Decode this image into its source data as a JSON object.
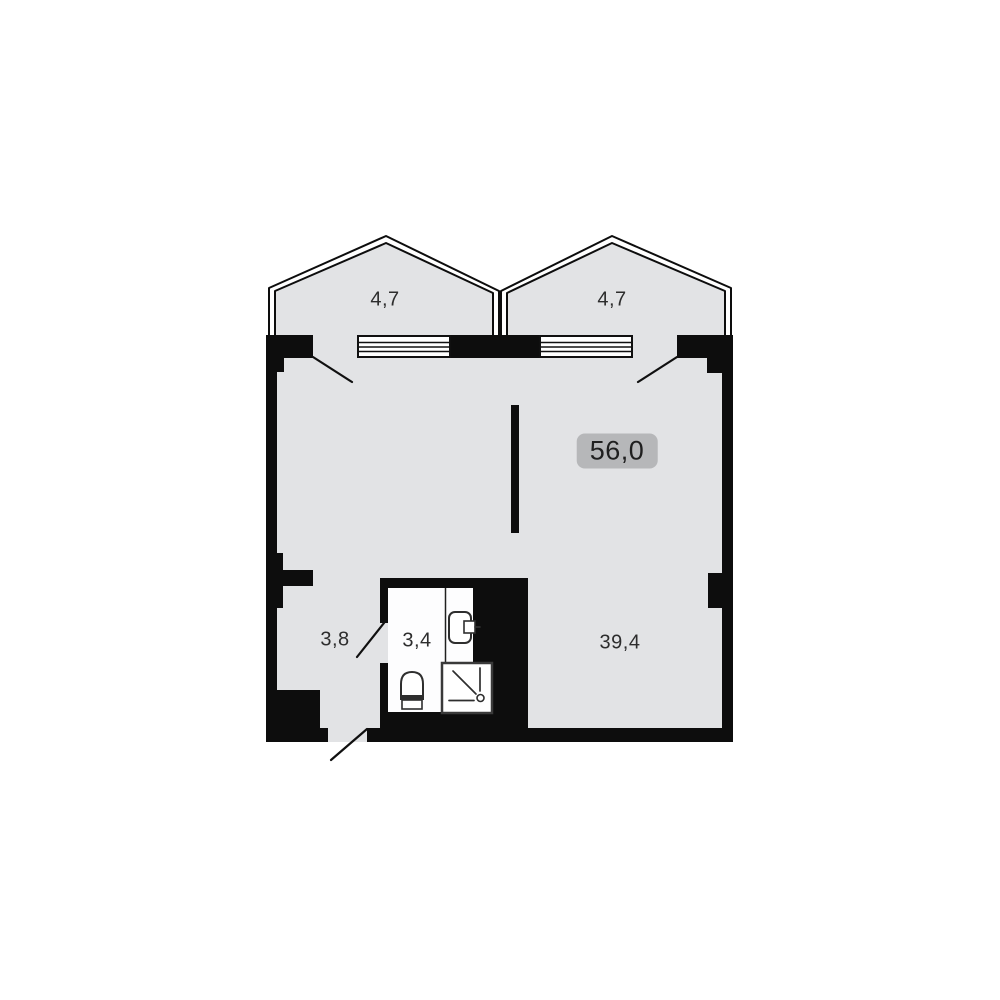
{
  "plan": {
    "total_area_badge": "56,0",
    "labels": {
      "balcony_left": "4,7",
      "balcony_right": "4,7",
      "hallway": "3,8",
      "bathroom": "3,4",
      "living_room": "39,4"
    },
    "colors": {
      "background": "#ffffff",
      "floor": "#e2e3e5",
      "wall": "#0d0d0d",
      "badge": "#b6b7b9"
    },
    "fixtures": [
      "sink-icon",
      "toilet-icon",
      "shower-icon"
    ]
  }
}
